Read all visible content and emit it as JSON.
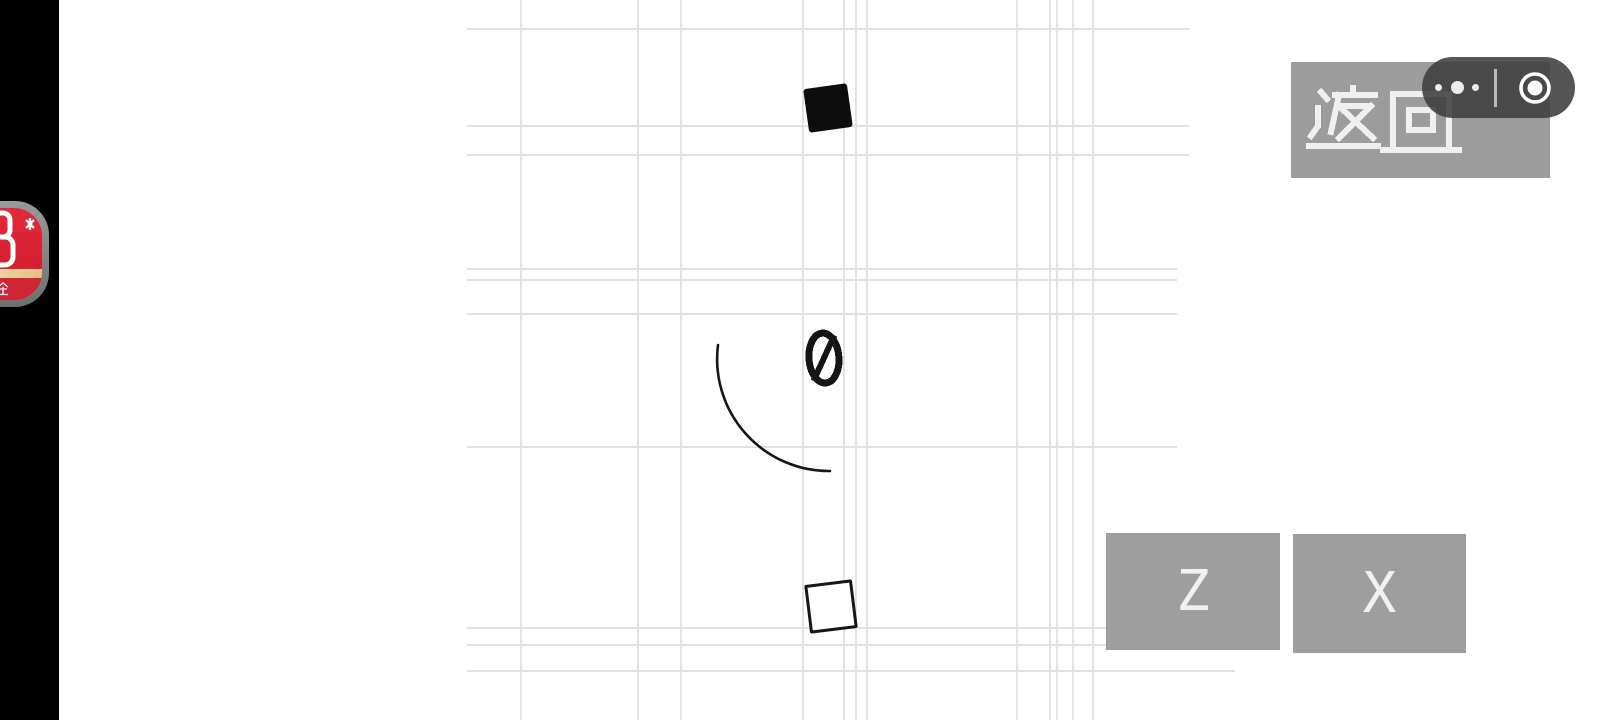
{
  "screen": {
    "width": 1600,
    "height": 720,
    "background": "#ffffff"
  },
  "letterbox": {
    "side": "left",
    "color": "#000000"
  },
  "game": {
    "score": {
      "value": "0"
    },
    "falling_block": {
      "shape": "filled-square",
      "color": "#0c0c0c"
    },
    "target_block": {
      "shape": "outline-square",
      "color": "#161616"
    },
    "trajectory": {
      "shape": "quarter-arc",
      "color": "#161616"
    },
    "grid": {
      "color": "#e2e2e2",
      "vertical_lines_x": [
        521,
        638,
        681,
        803,
        844,
        856,
        867,
        1017,
        1050,
        1057,
        1073,
        1093
      ],
      "horizontal_lines": [
        {
          "y": 29,
          "x1": 467,
          "x2": 1190
        },
        {
          "y": 126,
          "x1": 467,
          "x2": 1189
        },
        {
          "y": 155,
          "x1": 467,
          "x2": 1189
        },
        {
          "y": 269,
          "x1": 467,
          "x2": 1177
        },
        {
          "y": 280,
          "x1": 467,
          "x2": 1177
        },
        {
          "y": 314,
          "x1": 467,
          "x2": 1177
        },
        {
          "y": 447,
          "x1": 467,
          "x2": 1177
        },
        {
          "y": 628,
          "x1": 467,
          "x2": 1168
        },
        {
          "y": 645,
          "x1": 467,
          "x2": 1168
        },
        {
          "y": 671,
          "x1": 467,
          "x2": 1235
        }
      ]
    }
  },
  "back_button": {
    "label": "返回",
    "bg_color": "#9c9c9c",
    "text_color": "#f0f0f0"
  },
  "system_capsule": {
    "bg_color": "rgba(61,61,61,0.88)",
    "more_icon": "•••",
    "record_icon": "◉"
  },
  "action_buttons": [
    {
      "label": "Z"
    },
    {
      "label": "X"
    }
  ],
  "action_button_style": {
    "bg_color": "#9e9e9e",
    "text_color": "#f1f1f1"
  },
  "cash_widget": {
    "label": "现金",
    "bg_color": "#d6202f",
    "band_color": "#e6c187",
    "figure": "8",
    "sparkle_icon": "✳"
  }
}
